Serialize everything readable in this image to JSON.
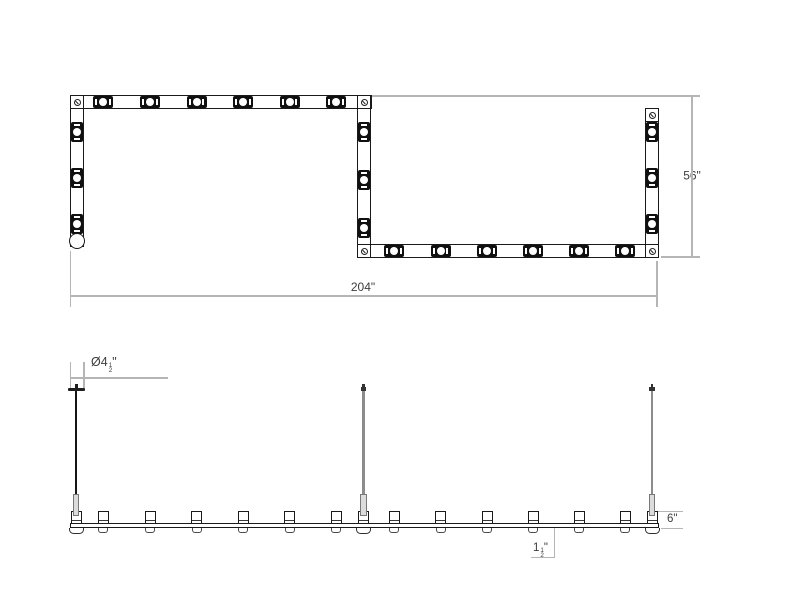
{
  "figure": {
    "type": "technical-dimension-drawing",
    "views": [
      "plan",
      "elevation"
    ]
  },
  "colors": {
    "fixture_line": "#1a1a1a",
    "module_fill": "#101010",
    "stem_gray": "#8c8c8c",
    "stem_black": "#161616",
    "turnbuckle_fill": "#dcdcdc",
    "dimension_line": "#b5b5b5",
    "dimension_text": "#3d3d3d",
    "background": "#ffffff"
  },
  "icons": {
    "corner_screw": "screw-head-circle-with-slash",
    "power_feed": "open-circle-end"
  },
  "dimensions": {
    "overall_width_label": "204\"",
    "depth_label": "56\"",
    "height_label": "6\"",
    "canopy_diameter": {
      "prefix": "Ø",
      "whole": "4",
      "num": "1",
      "den": "2",
      "unit": "\""
    },
    "bar_height": {
      "whole": "1",
      "num": "1",
      "den": "2",
      "unit": "\""
    }
  },
  "plan": {
    "module_count": 21,
    "top_run_modules": 6,
    "bottom_run_modules": 6,
    "left_run_modules": 3,
    "middle_run_modules": 3,
    "right_run_modules": 3,
    "corner_screw_count": 5
  },
  "elevation": {
    "lamp_count": 15,
    "stem_count": 3
  }
}
